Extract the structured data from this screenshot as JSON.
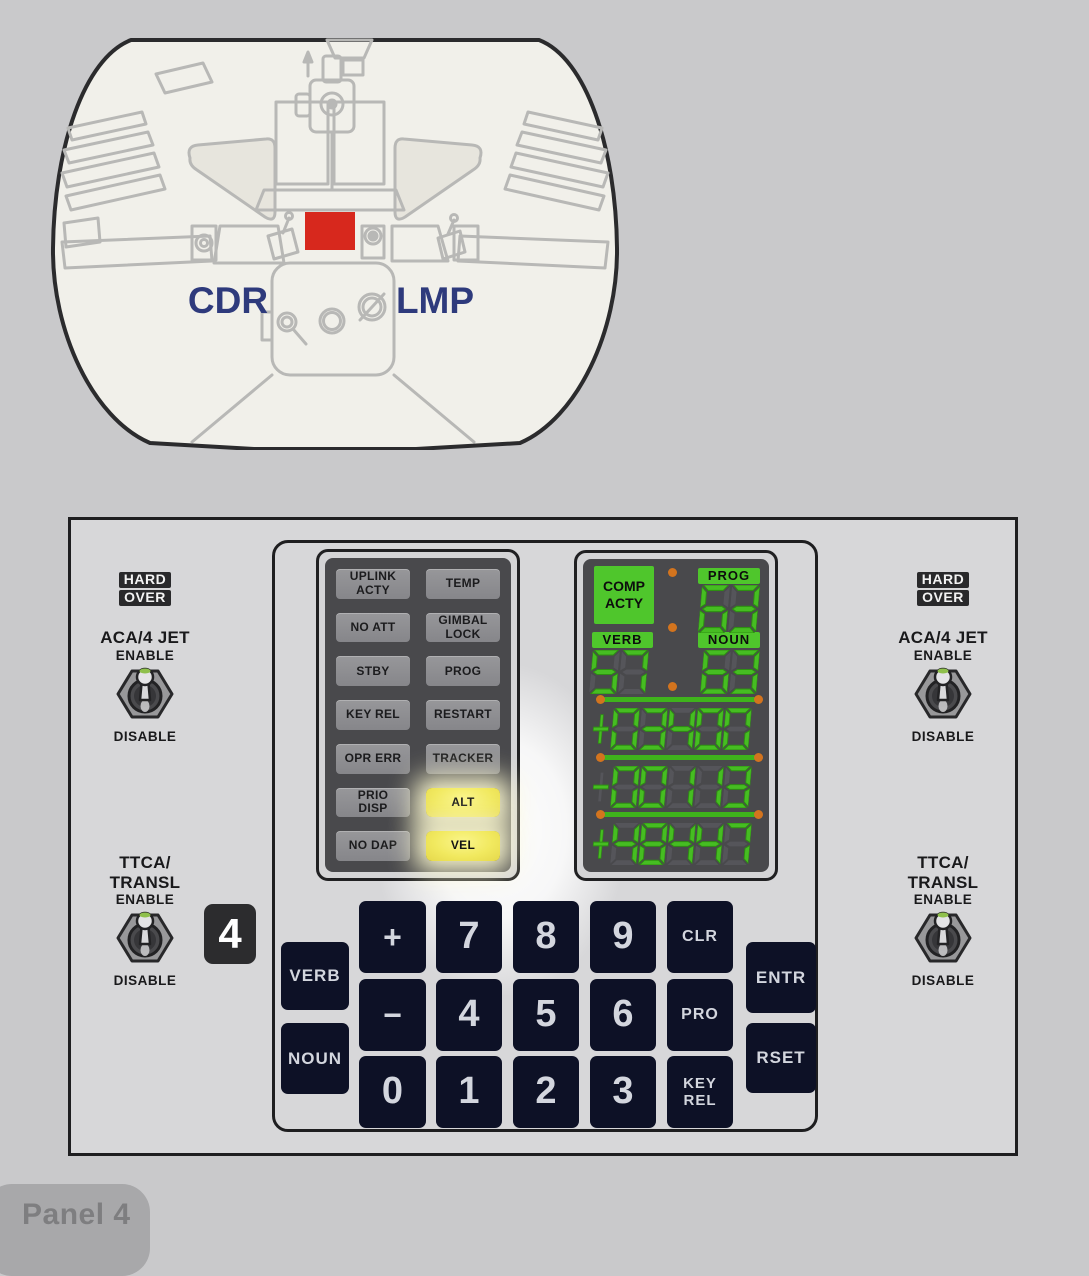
{
  "diagram": {
    "cdr": "CDR",
    "lmp": "LMP"
  },
  "footer": {
    "label": "Panel 4"
  },
  "panel_badge": "4",
  "side_controls": {
    "hard": "HARD",
    "over": "OVER",
    "aca_title": "ACA/4 JET",
    "ttca_title": "TTCA/\nTRANSL",
    "enable": "ENABLE",
    "disable": "DISABLE"
  },
  "status": {
    "cells": [
      {
        "label": "UPLINK\nACTY",
        "lit": "false"
      },
      {
        "label": "TEMP",
        "lit": "false"
      },
      {
        "label": "NO ATT",
        "lit": "false"
      },
      {
        "label": "GIMBAL\nLOCK",
        "lit": "false"
      },
      {
        "label": "STBY",
        "lit": "false"
      },
      {
        "label": "PROG",
        "lit": "false"
      },
      {
        "label": "KEY REL",
        "lit": "false"
      },
      {
        "label": "RESTART",
        "lit": "false"
      },
      {
        "label": "OPR ERR",
        "lit": "false"
      },
      {
        "label": "TRACKER",
        "lit": "false"
      },
      {
        "label": "PRIO\nDISP",
        "lit": "false"
      },
      {
        "label": "ALT",
        "lit": "true"
      },
      {
        "label": "NO DAP",
        "lit": "false"
      },
      {
        "label": "VEL",
        "lit": "true"
      }
    ]
  },
  "display": {
    "comp_acty": "COMP\nACTY",
    "prog_label": "PROG",
    "verb_label": "VERB",
    "noun_label": "NOUN",
    "prog": "63",
    "verb": "57",
    "noun": "63",
    "registers": [
      "+03400",
      "-00113",
      "+48447"
    ],
    "colors": {
      "segment_green": "#46bd22",
      "dot_orange": "#d3741e",
      "lit_yellow": "#f1e95f"
    }
  },
  "keypad": {
    "verb": "VERB",
    "noun": "NOUN",
    "plus": "+",
    "minus": "−",
    "d0": "0",
    "d1": "1",
    "d2": "2",
    "d3": "3",
    "d4": "4",
    "d5": "5",
    "d6": "6",
    "d7": "7",
    "d8": "8",
    "d9": "9",
    "clr": "CLR",
    "pro": "PRO",
    "key_rel": "KEY\nREL",
    "entr": "ENTR",
    "rset": "RSET"
  },
  "highlight_color": "#d7281d"
}
